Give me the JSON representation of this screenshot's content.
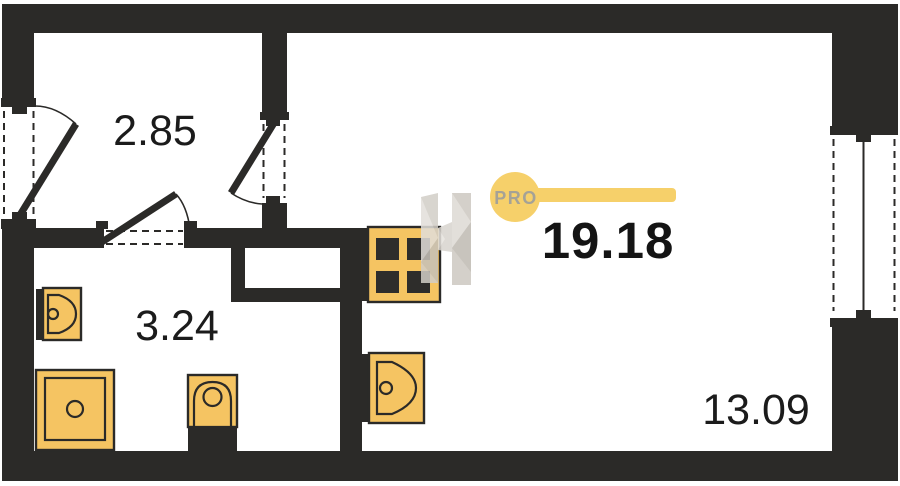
{
  "plan": {
    "rooms": [
      {
        "id": "hallway",
        "area": "2.85"
      },
      {
        "id": "bathroom",
        "area": "3.24"
      },
      {
        "id": "living-room",
        "area": "13.09"
      }
    ],
    "total_area": "19.18",
    "badge": {
      "label": "PRO"
    },
    "fixtures": [
      "bathroom-sink",
      "shower",
      "toilet",
      "stove",
      "kitchen-sink"
    ],
    "colors": {
      "wall": "#2B2A28",
      "fixture_fill": "#F5C462",
      "badge_fill": "#F6D06A",
      "badge_text": "#A5A296",
      "label_text": "#1B1B1B",
      "watermark": "#D2CEC7",
      "background": "#FFFFFF"
    }
  }
}
